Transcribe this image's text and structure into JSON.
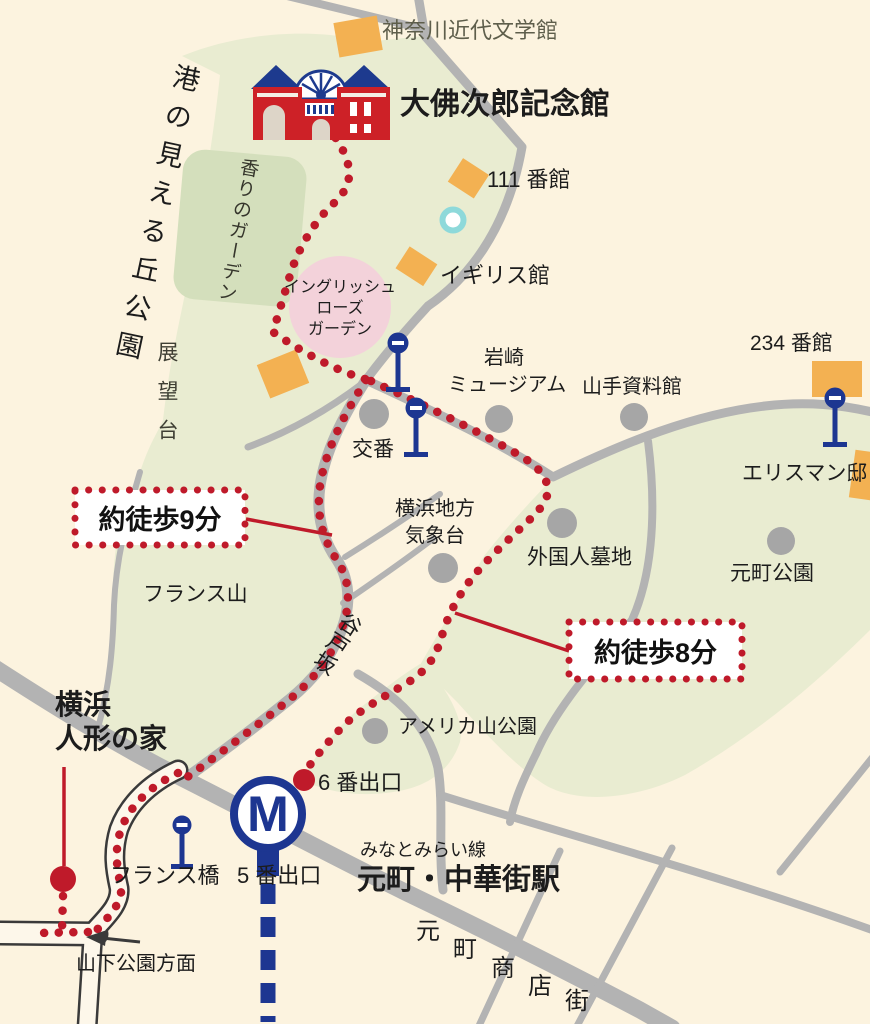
{
  "colors": {
    "background_cream": "#fcf3df",
    "park_green": "#e9ecd1",
    "garden_green": "#d4dfbc",
    "rose_garden_pink": "#f3d2da",
    "building_orange": "#f3b152",
    "road_gray": "#b3b3b3",
    "route_red": "#bf1a2a",
    "landmark_gray": "#a6a6a6",
    "memorial_red": "#cd2127",
    "metro_blue": "#1d3691",
    "pond_teal": "#8ed9da",
    "text_black": "#1c1c1c"
  },
  "labels": {
    "kanagawa_literature_museum": "神奈川近代文学館",
    "osaragi_memorial_hall": "大佛次郎記念館",
    "harbor_view_park": "港の見える丘公園",
    "observation_deck": "展望台",
    "fragrance_garden": "香りのガーデン",
    "house_111": "111 番館",
    "england_house": "イギリス館",
    "rose_garden": [
      "イングリッシュ",
      "ローズ",
      "ガーデン"
    ],
    "iwasaki_museum": [
      "岩崎",
      "ミュージアム"
    ],
    "yamate_museum": "山手資料館",
    "house_234": "234 番館",
    "ehrisman_house": "エリスマン邸",
    "motomachi_park": "元町公園",
    "koban": "交番",
    "weather_observatory": [
      "横浜地方",
      "気象台"
    ],
    "foreigners_cemetery": "外国人墓地",
    "walk_9min": "約徒歩9分",
    "france_hill": "フランス山",
    "yatozaka": "谷戸坂",
    "walk_8min": "約徒歩8分",
    "doll_museum": [
      "横浜",
      "人形の家"
    ],
    "americayama_park": "アメリカ山公園",
    "exit_6": "6 番出口",
    "france_bridge": "フランス橋",
    "exit_5": "5 番出口",
    "minatomirai_line": "みなとみらい線",
    "station_name": "元町・中華街駅",
    "yamashita_direction": "山下公園方面",
    "shopping_street": [
      "元",
      "町",
      "商",
      "店",
      "街"
    ],
    "metro_mark": "M"
  }
}
